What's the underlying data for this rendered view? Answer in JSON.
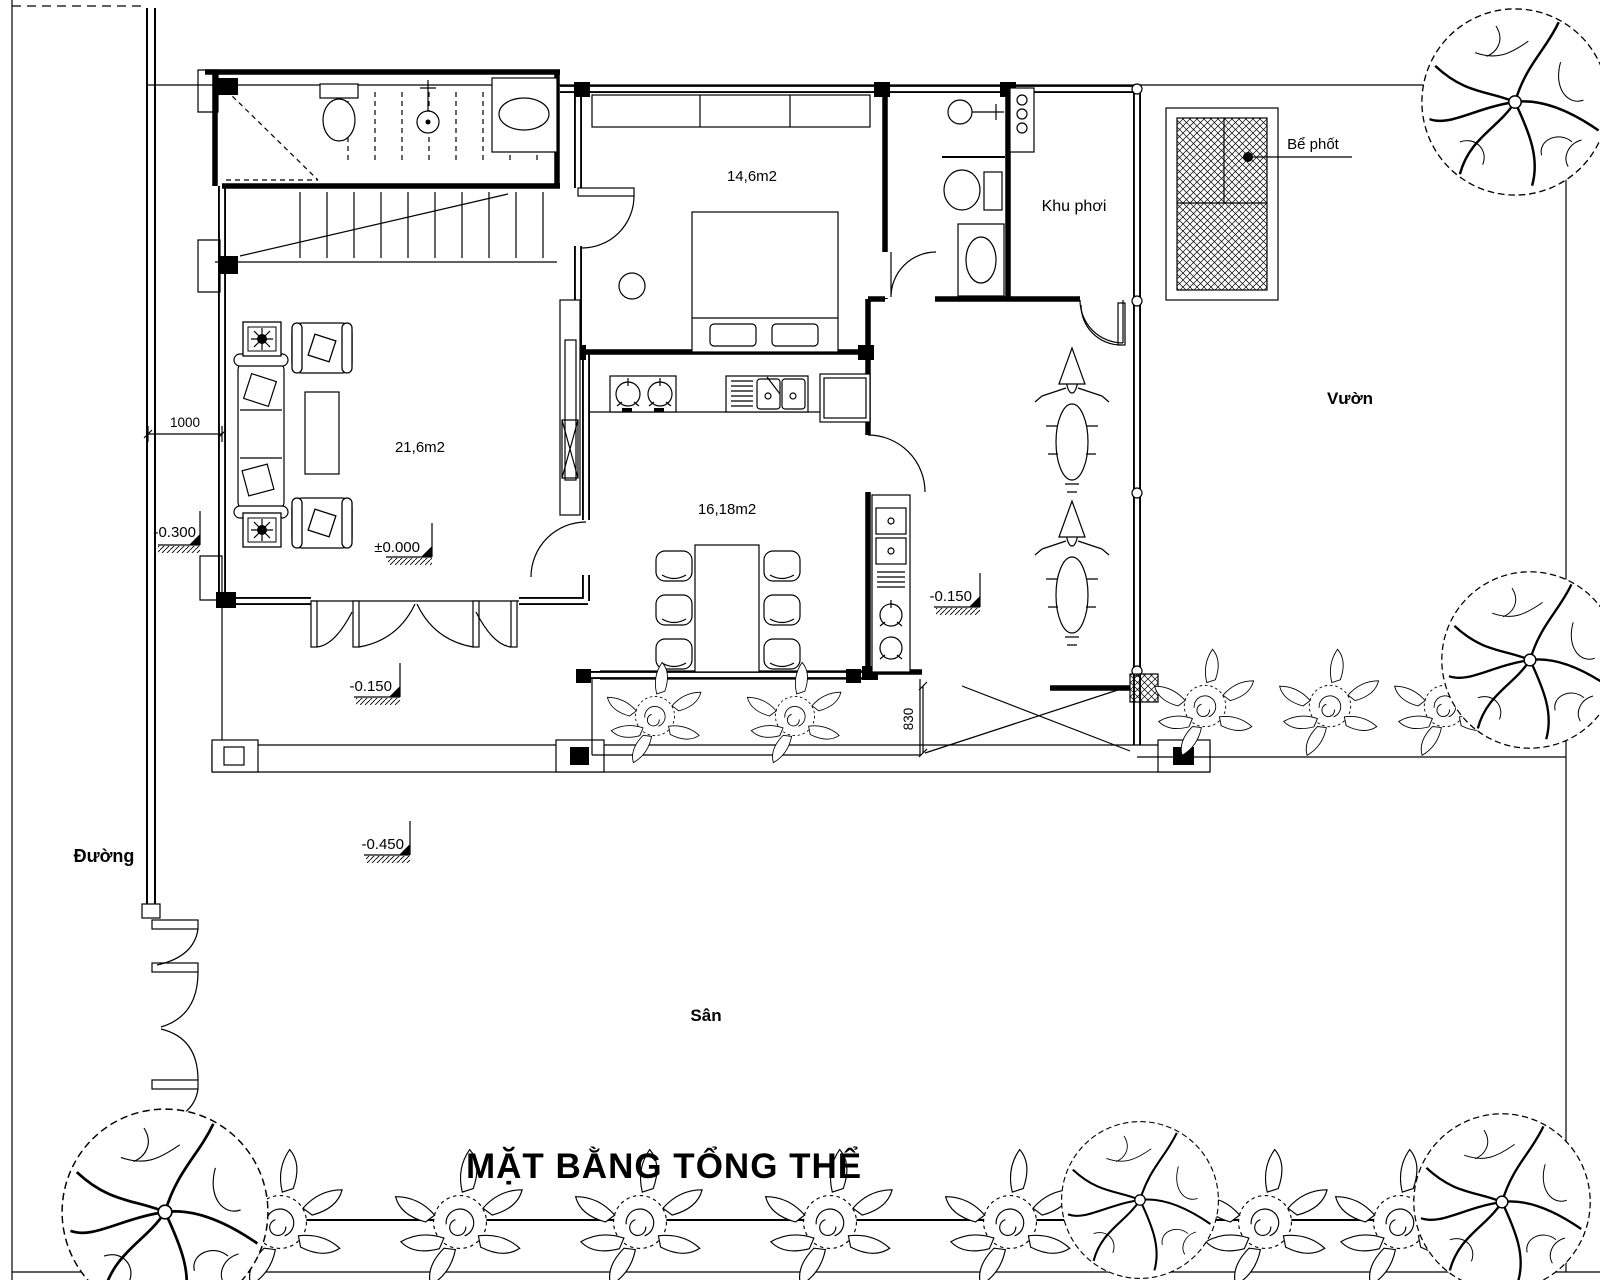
{
  "colors": {
    "ink": "#000000",
    "paper": "#ffffff"
  },
  "title": {
    "text": "MẶT BẰNG TỔNG THỂ"
  },
  "site": {
    "road": "Đường",
    "yard": "Sân",
    "garden": "Vườn"
  },
  "rooms": {
    "living": {
      "area": "21,6m2"
    },
    "bedroom": {
      "area": "14,6m2"
    },
    "dining": {
      "area": "16,18m2"
    },
    "drying": {
      "name": "Khu phơi"
    }
  },
  "equipment": {
    "septic": "Bể phốt"
  },
  "levels": {
    "zero": "±0.000",
    "porch": "-0.150",
    "garage": "-0.150",
    "yard": "-0.450",
    "sidewalk": "-0.300"
  },
  "dims": {
    "setback": "1000",
    "garage_door": "830"
  }
}
